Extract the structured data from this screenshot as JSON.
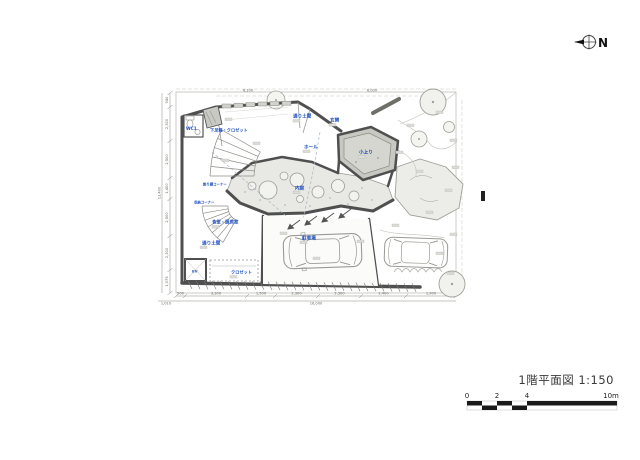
{
  "title_block": {
    "text": "1階平面図 1:150"
  },
  "compass": {
    "label": "N"
  },
  "scale_bar": {
    "tick_labels": [
      "0",
      "2",
      "4",
      "10m"
    ]
  },
  "colors": {
    "label_blue": "#2050c0",
    "wall_gray": "#4f4f4f",
    "raised_floor_gray": "#c8c8c2",
    "garden_line_gray": "#a0a09a"
  },
  "plan": {
    "rooms": [
      {
        "name": "wc",
        "label": "WC1"
      },
      {
        "name": "shoe-closet",
        "label": "下足箱・クロゼット"
      },
      {
        "name": "doma-top",
        "label": "通り土間"
      },
      {
        "name": "genkan",
        "label": "玄関"
      },
      {
        "name": "hall",
        "label": "ホール"
      },
      {
        "name": "koagari",
        "label": "小上り"
      },
      {
        "name": "uchiniwa",
        "label": "内庭"
      },
      {
        "name": "shelf-corner",
        "label": "飾り棚コーナー"
      },
      {
        "name": "storage-corner",
        "label": "収納コーナー"
      },
      {
        "name": "dining-kitchen",
        "label": "食堂・厨房室"
      },
      {
        "name": "doma-bottom",
        "label": "通り土間"
      },
      {
        "name": "elevator",
        "label": "EV"
      },
      {
        "name": "closet",
        "label": "クロゼット"
      },
      {
        "name": "parking",
        "label": "駐車場"
      }
    ],
    "dimensions": {
      "bottom": [
        "500",
        "3,300",
        "1,500",
        "2,300",
        "2,300",
        "2,400",
        "1,900"
      ],
      "bottom_total": "16,000",
      "bottom_offset": "1,010",
      "left": [
        "940",
        "2,300",
        "2,500",
        "1,400",
        "2,500",
        "2,300",
        "1,075"
      ],
      "left_total": "13,400",
      "top": [
        "6,100",
        "6,000"
      ]
    }
  }
}
